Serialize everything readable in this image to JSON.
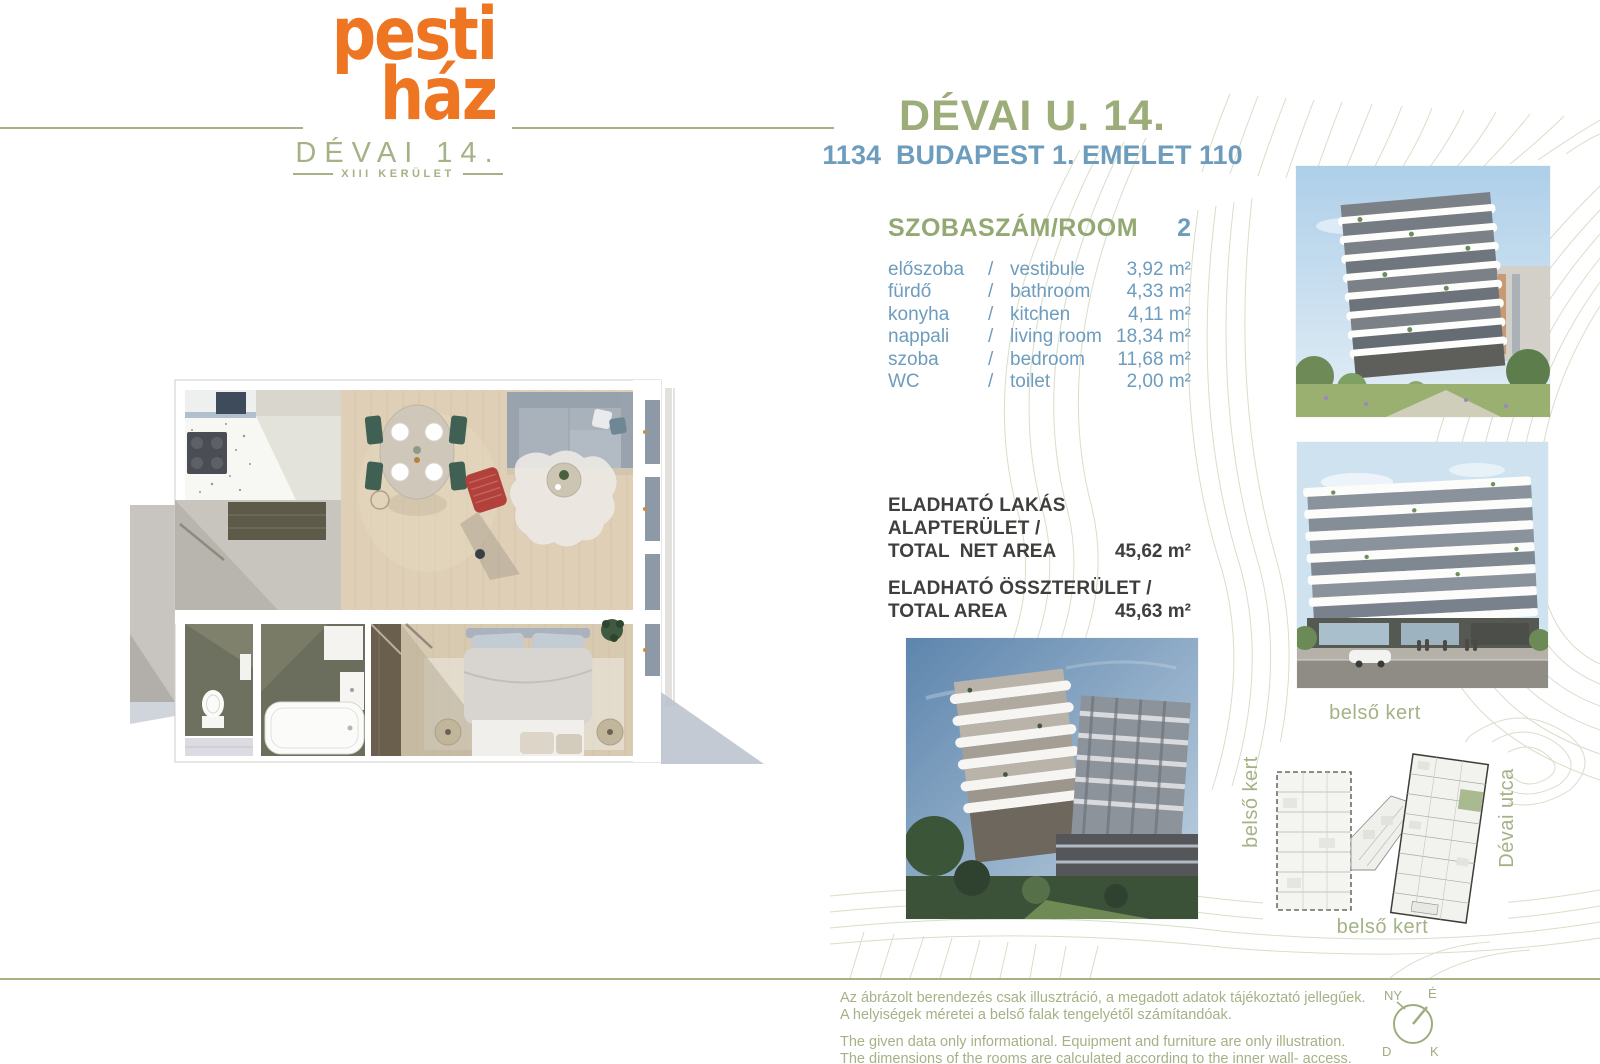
{
  "brand": {
    "logo_line1": "pesti",
    "logo_line2": "ház",
    "logo_sub": "DÉVAI 14.",
    "logo_district": "XIII  KERÜLET",
    "orange": "#ee7521",
    "sage": "#a4b286",
    "blue": "#6d9cbd"
  },
  "header": {
    "title": "DÉVAI U. 14.",
    "subtitle": "1134  BUDAPEST 1. EMELET 110"
  },
  "rooms": {
    "header": "SZOBASZÁM/ROOM",
    "count": "2",
    "separator": "/",
    "items": [
      {
        "hu": "előszoba",
        "en": "vestibule",
        "area": "3,92 m²"
      },
      {
        "hu": "fürdő",
        "en": "bathroom",
        "area": "4,33 m²"
      },
      {
        "hu": "konyha",
        "en": "kitchen",
        "area": "4,11 m²"
      },
      {
        "hu": "nappali",
        "en": "living room",
        "area": "18,34 m²"
      },
      {
        "hu": "szoba",
        "en": "bedroom",
        "area": "11,68 m²"
      },
      {
        "hu": "WC",
        "en": "toilet",
        "area": "2,00 m²"
      }
    ]
  },
  "totals": [
    {
      "label_hu": "ELADHATÓ LAKÁS ALAPTERÜLET /",
      "label_en": "TOTAL  NET AREA",
      "value": "45,62 m²"
    },
    {
      "label_hu": "ELADHATÓ ÖSSZTERÜLET /",
      "label_en": "TOTAL AREA",
      "value": "45,63 m²"
    }
  ],
  "siteplan": {
    "label_top": "belső kert",
    "label_left": "belső kert",
    "label_right": "Dévai utca",
    "label_bottom": "belső kert",
    "highlight_color": "#a9ba90"
  },
  "compass": {
    "nw": "NY",
    "ne": "É",
    "sw": "D",
    "se": "K"
  },
  "footer": {
    "hu_line1": "Az ábrázolt berendezés csak illusztráció, a megadott adatok tájékoztató jellegűek.",
    "hu_line2": "A helyiségek méretei a belső falak tengelyétől számítandóak.",
    "en_line1": "The given data only informational. Equipment and furniture are only illustration.",
    "en_line2": "The dimensions of the rooms are calculated according to the inner wall- access."
  }
}
